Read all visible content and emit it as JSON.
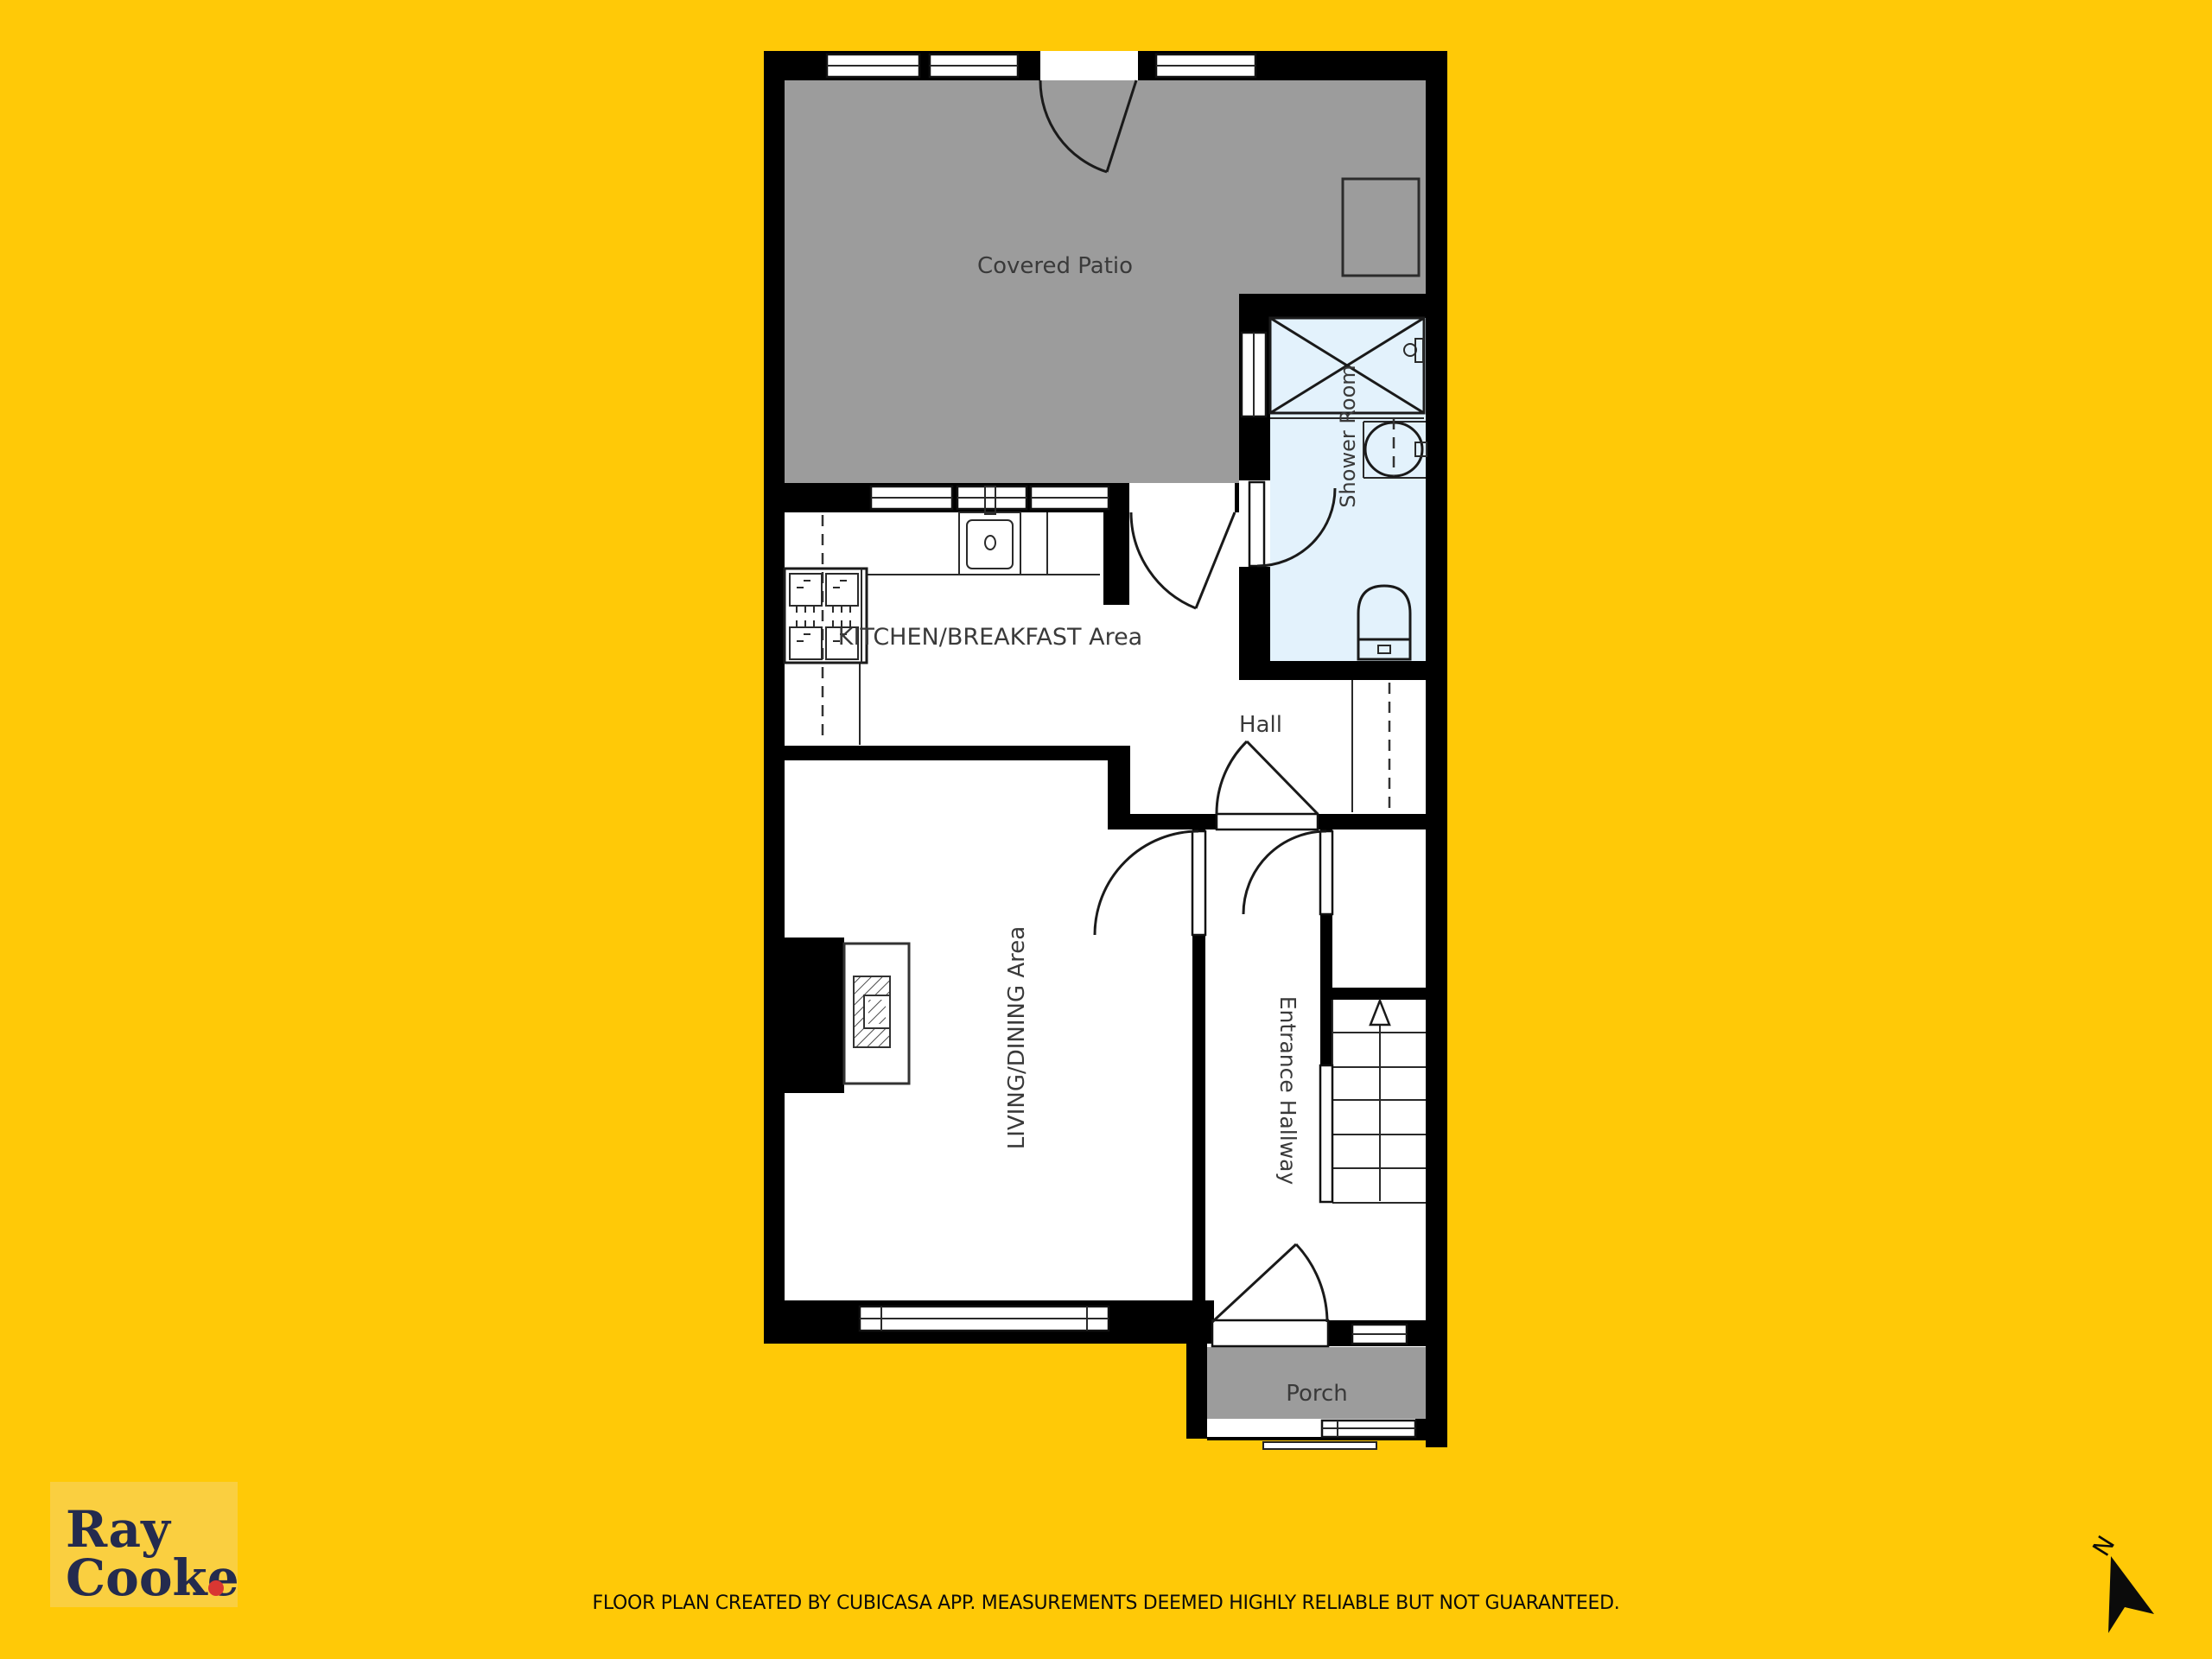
{
  "canvas": {
    "bg": "#FFC907"
  },
  "colors": {
    "wall": "#000000",
    "outdoor_gray": "#9C9C9C",
    "shower_blue": "#E3F2FC",
    "room_text": "#3A3A3A",
    "logo_bg": "#FACF40",
    "logo_navy": "#242B4E",
    "logo_dot": "#D93732",
    "disclaimer_text": "#0A0A0A",
    "north": "#0B0B0B"
  },
  "rooms": {
    "covered_patio": "Covered Patio",
    "shower_room": "Shower Room",
    "kitchen": "KITCHEN/BREAKFAST Area",
    "hall": "Hall",
    "living": "LIVING/DINING Area",
    "entrance": "Entrance Hallway",
    "porch": "Porch"
  },
  "logo": {
    "line1": "Ray",
    "line2": "Cooke"
  },
  "footer": {
    "disclaimer": "FLOOR PLAN CREATED BY CUBICASA APP. MEASUREMENTS DEEMED HIGHLY RELIABLE BUT NOT GUARANTEED."
  },
  "compass": {
    "label": "N"
  }
}
